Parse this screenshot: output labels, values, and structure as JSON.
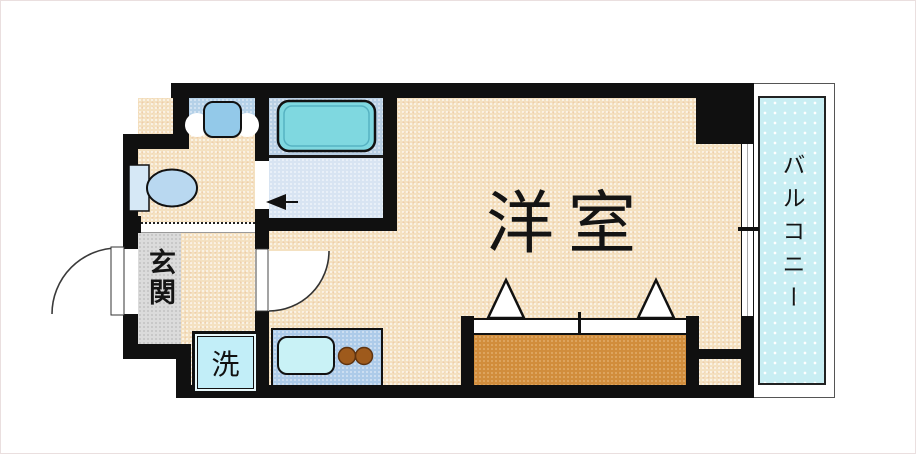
{
  "document": {
    "type": "floor-plan",
    "description": "Japanese one-room apartment floor plan"
  },
  "labels": {
    "main_room": "洋室",
    "entrance": "玄関",
    "balcony": "バルコニー",
    "washer": "洗"
  },
  "fixtures": [
    "bathtub-icon",
    "toilet-icon",
    "washbasin-icon",
    "kitchen-sink-icon",
    "gas-burner-icons",
    "washing-machine-space",
    "closet-folding-doors",
    "entrance-door-arc",
    "room-door-arc",
    "bathroom-door-arrow",
    "sliding-window"
  ],
  "colors": {
    "wall": "#101010",
    "floor_beige": "#f4e1c1",
    "bathroom_upper": "#b9cfe4",
    "bathroom_lower": "#d8e4f2",
    "bathtub": "#7fd8e0",
    "fixture_blue": "#93c9e9",
    "genkan_gray": "#dbdbdb",
    "balcony_cyan": "#c9eef3",
    "closet_orange": "#d18d3c",
    "kitchen_counter": "#adcbe9",
    "sink_cyan": "#c9f2f6",
    "burner_brown": "#9e5a1c",
    "washer_panel": "#c2eef8"
  }
}
